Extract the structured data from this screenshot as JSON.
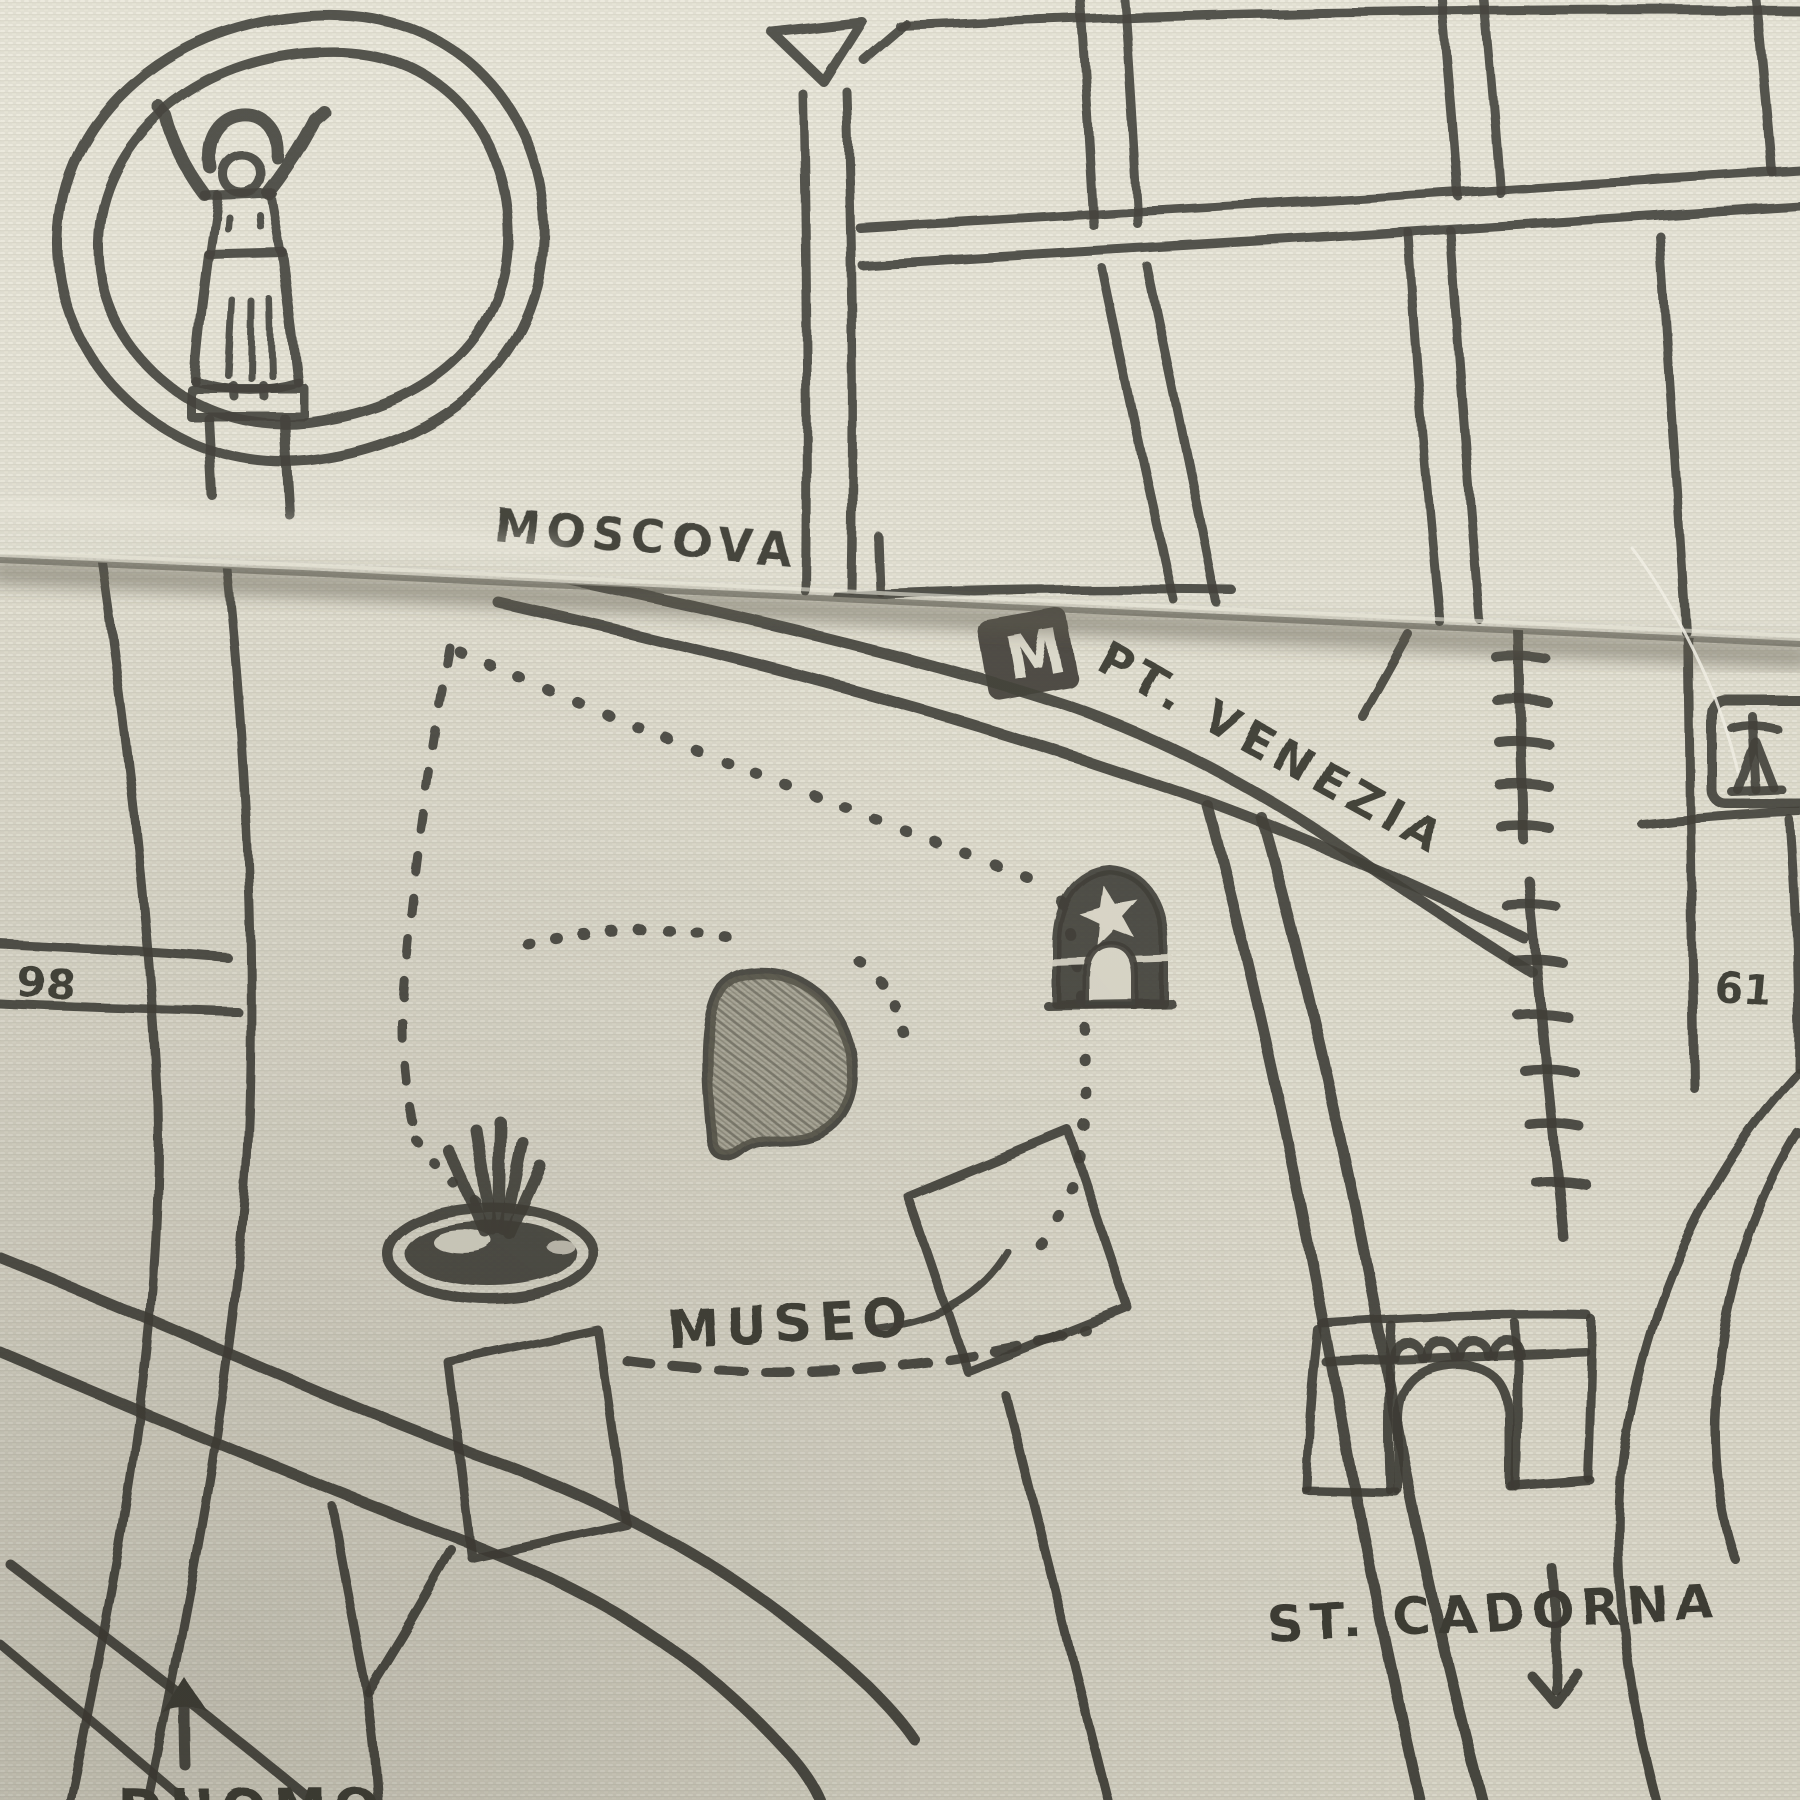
{
  "artwork": {
    "description": "Hand-drawn city map printed on folded cream fabric",
    "style": "sketched charcoal ink on woven textile"
  },
  "colors": {
    "fabric": "#dedbcc",
    "fabric_fold": "#e4e1d3",
    "ink": "#3b3a33",
    "pond_fill": "#73705f",
    "shadow": "#565246",
    "thread": "#f4f2e8"
  },
  "labels": {
    "moscova": "MOSCOVA",
    "pt_venezia": "PT. VENEZIA",
    "museo": "MUSEO",
    "st_cadorna": "ST. CADORNA",
    "duomo": "DUOMO",
    "route_61": "61",
    "route_98": "98",
    "metro_m": "M"
  },
  "icons": {
    "statue": "statue-figure-on-pedestal",
    "metro": "metro-station-m-sign",
    "star_gate": "domed-gate-with-star",
    "fountain": "fountain-with-spray",
    "pond": "shaded-pond",
    "museum": "museum-building-outline",
    "arch": "triumphal-arch-monument",
    "railway": "railway-crossing-ticks",
    "arrow_up": "direction-arrow-up",
    "arrow_down": "direction-arrow-down",
    "triangle_plaza": "triangle-plaza",
    "ring_road": "oval-ring-road",
    "monument_plaque": "framed-monument-icon"
  }
}
